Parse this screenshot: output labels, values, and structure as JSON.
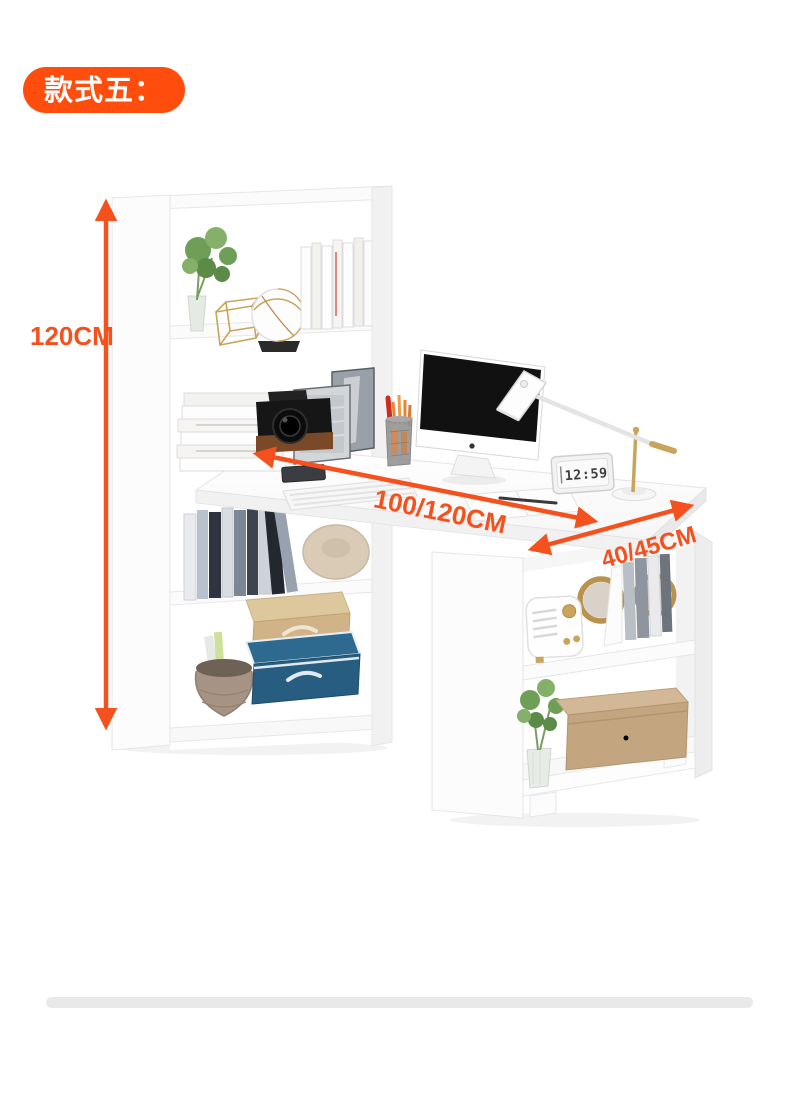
{
  "badge": {
    "label": "款式五："
  },
  "dimensions": {
    "height_label": "120CM",
    "width_label": "100/120CM",
    "depth_label": "40/45CM"
  },
  "desk_clock": {
    "time": "12:59"
  },
  "colors": {
    "accent_orange": "#F4511E",
    "badge_background": "#FF4D0D",
    "badge_text": "#FFFFFF",
    "divider_gray": "#E9E9E9",
    "furniture_white": "#FFFFFF",
    "storage_box_blue": "#2E6A8F",
    "storage_box_beige": "#D9C291",
    "wooden_box_tan": "#C7AD92",
    "lamp_gold": "#C9A45C",
    "plant_green": "#6F9E57"
  }
}
